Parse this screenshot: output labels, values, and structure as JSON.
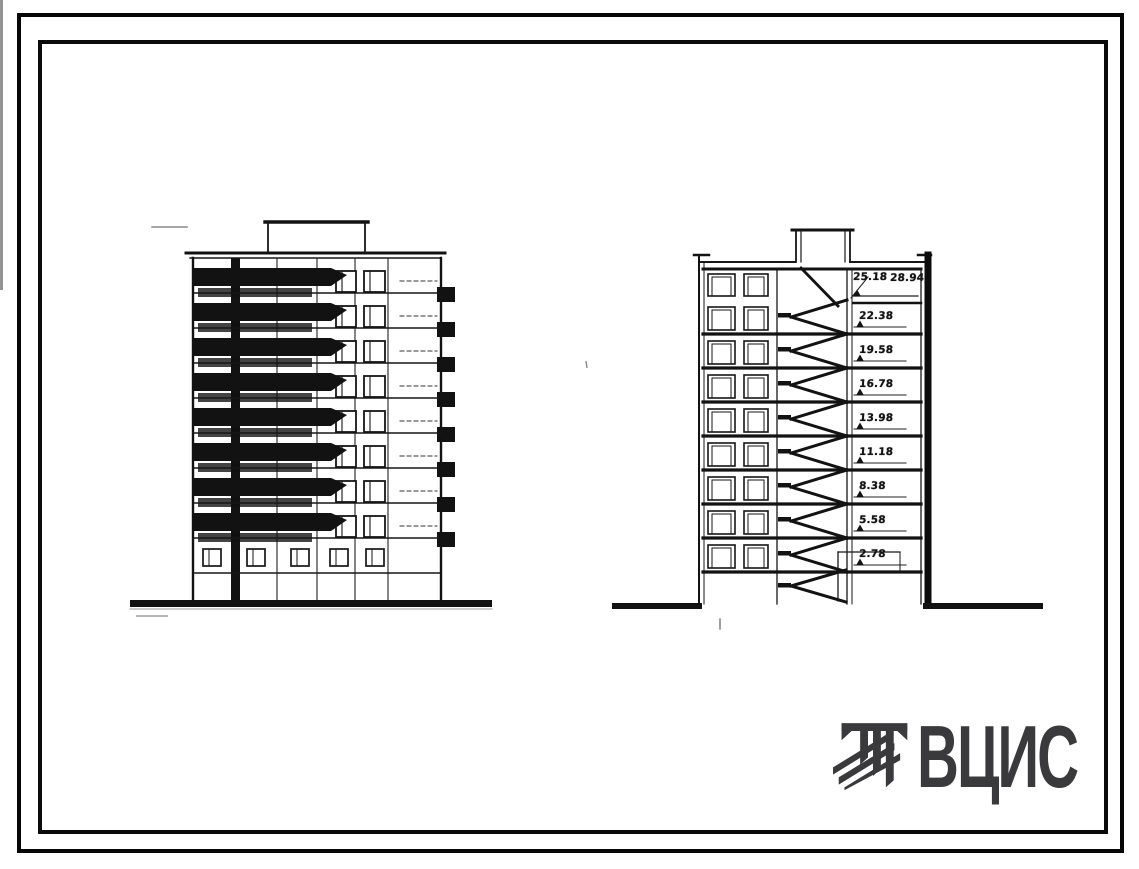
{
  "page": {
    "paper_color": "#ffffff",
    "ink_color": "#141414",
    "frame_color": "#000000"
  },
  "section_marks": {
    "roof_pair": [
      "25.18",
      "28.94"
    ],
    "floor_marks": [
      "22.38",
      "19.58",
      "16.78",
      "13.98",
      "11.18",
      "8.38",
      "5.58",
      "2.78"
    ]
  },
  "logo": {
    "text": "ВЦИС",
    "color": "#3a3a3d"
  }
}
